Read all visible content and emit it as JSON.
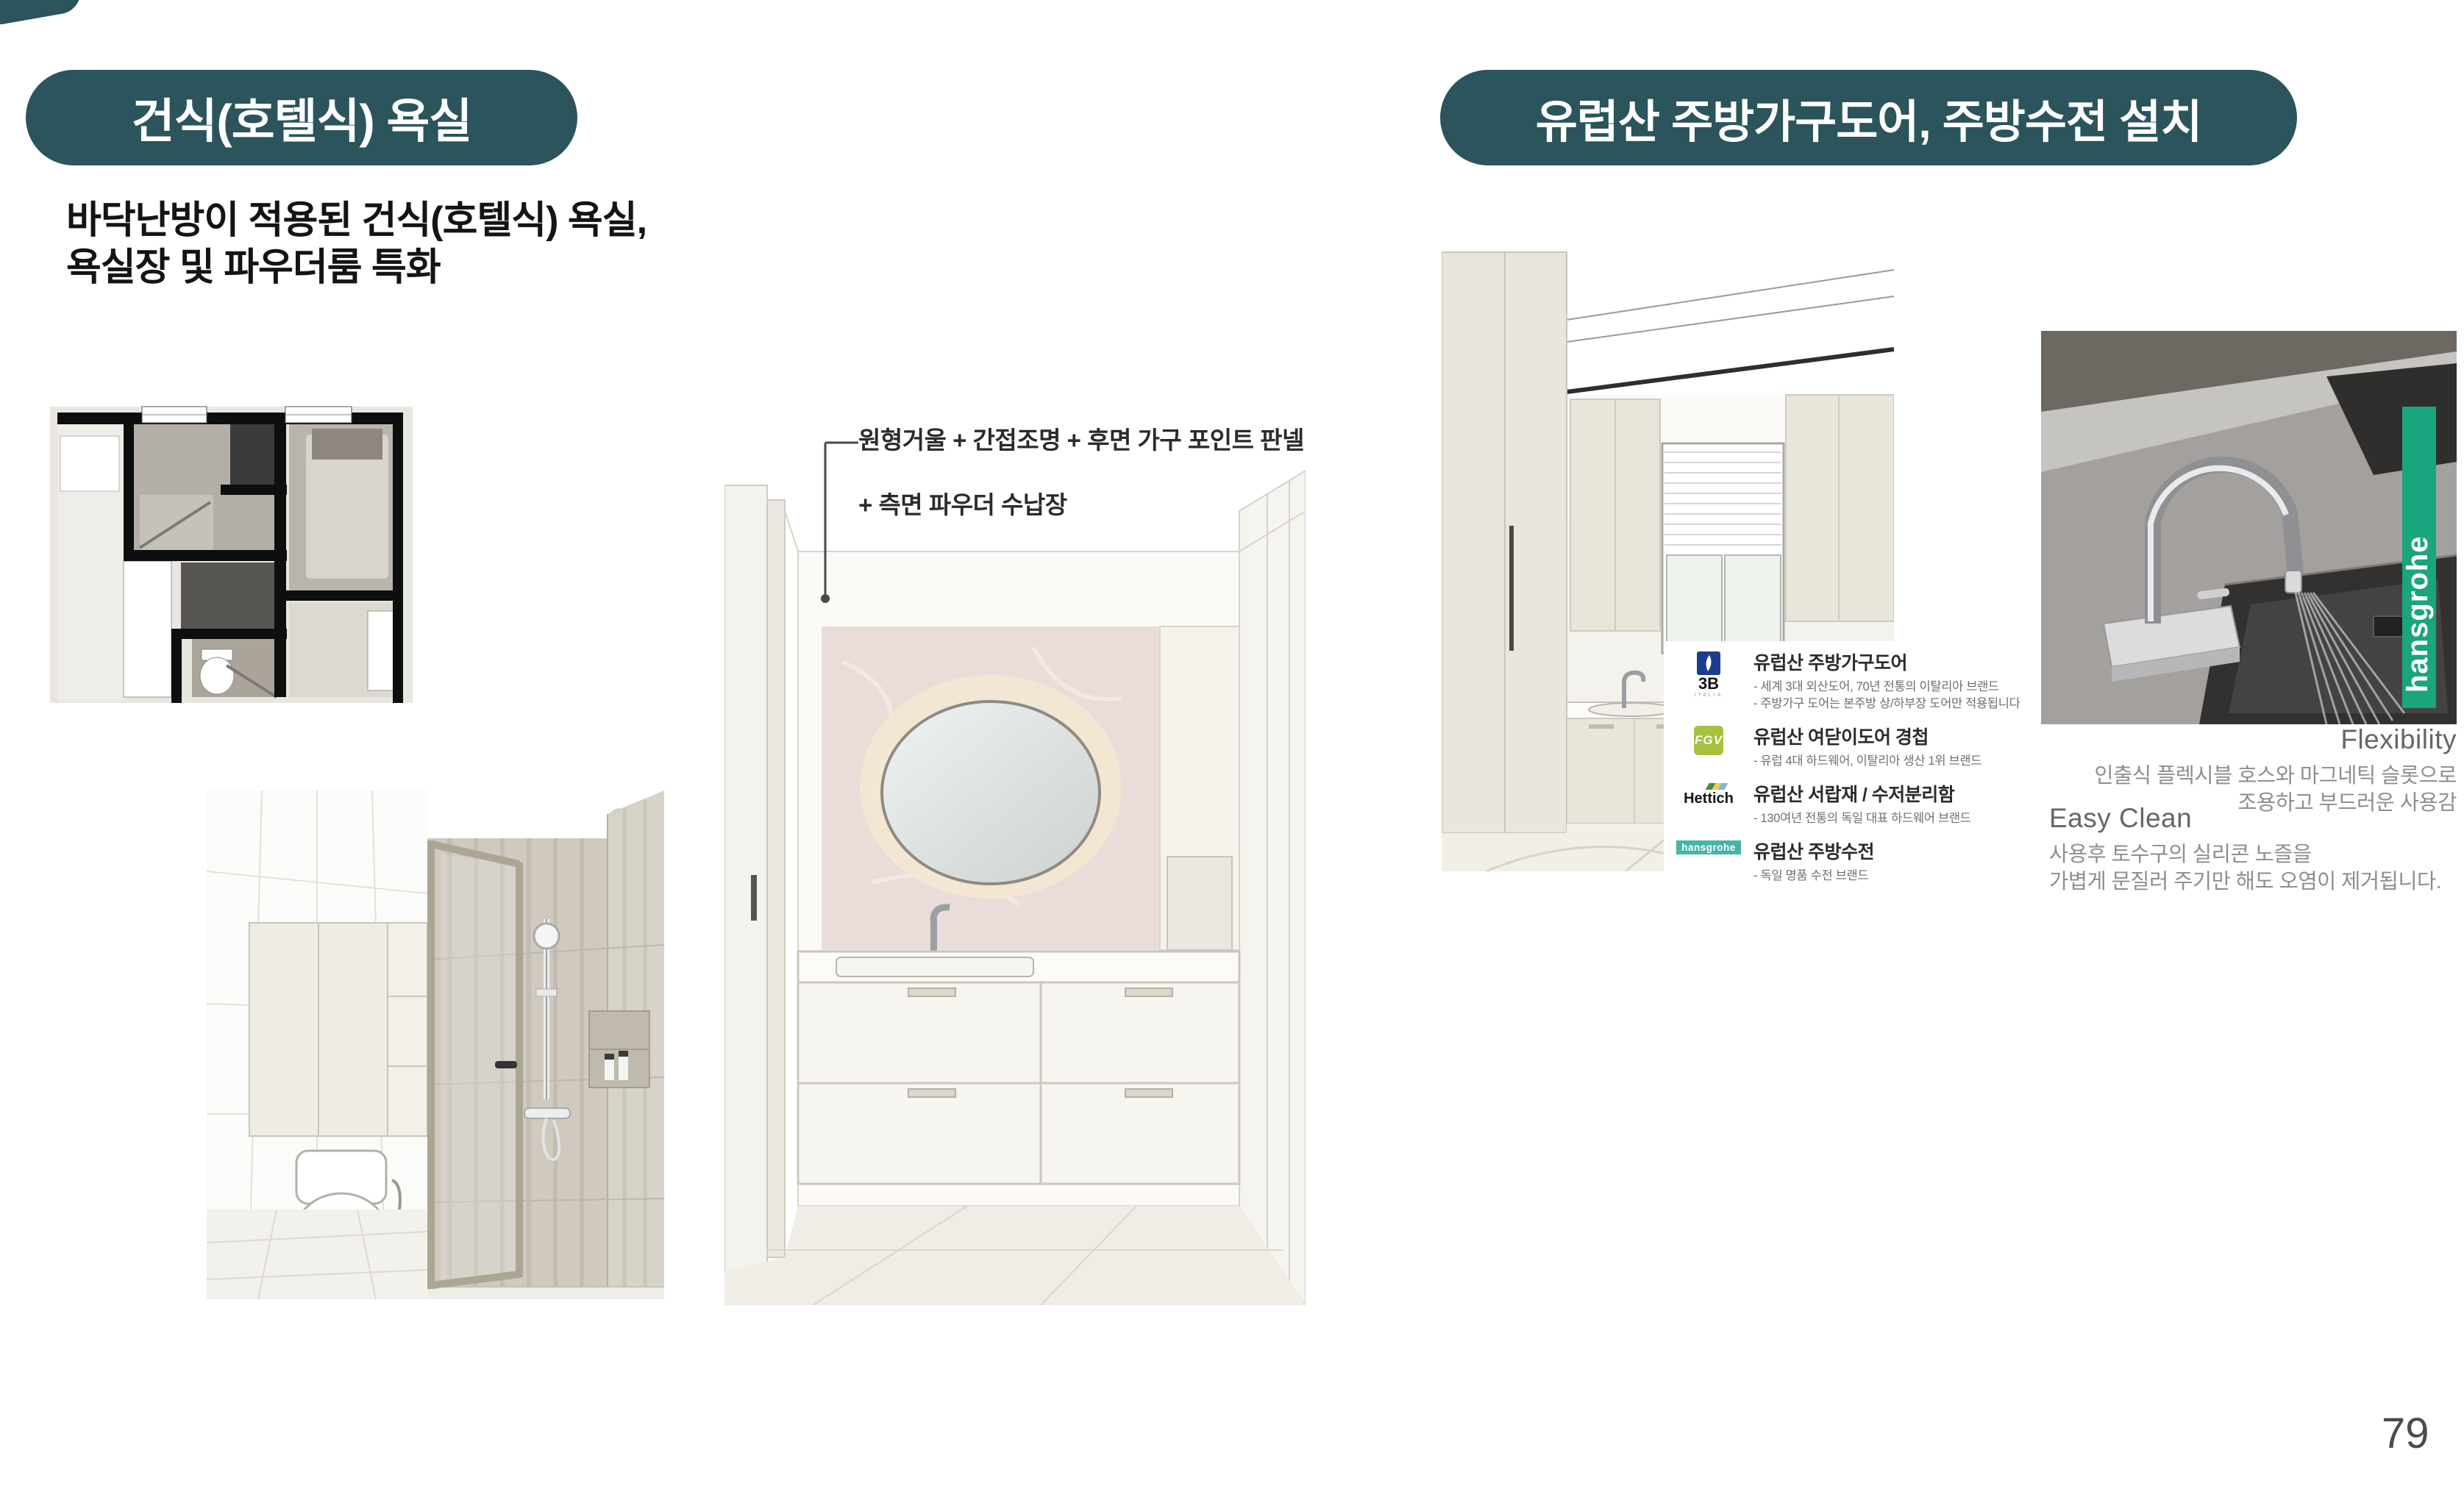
{
  "page": {
    "number": "79"
  },
  "colors": {
    "accent_teal": "#2b545c",
    "hansgrohe_green": "#19a57e",
    "hansgrohe_logo_teal": "#44b5a6",
    "b3_blue": "#1c3d8e",
    "fgv_green": "#a6c23e"
  },
  "left_section": {
    "badge_label": "건식(호텔식) 욕실",
    "description": {
      "line1": "바닥난방이 적용된 건식(호텔식) 욕실,",
      "line2": "욕실장 및 파우더룸 특화"
    },
    "powder_annotation": {
      "line1": "원형거울 + 간접조명 + 후면 가구 포인트 판넬",
      "line2": "+ 측면 파우더 수납장"
    }
  },
  "right_section": {
    "badge_label": "유럽산 주방가구도어, 주방수전 설치",
    "brands": [
      {
        "logo_text": "3B",
        "logo_sub": "ITALIA",
        "title": "유럽산 주방가구도어",
        "desc1": "- 세계 3대 외산도어, 70년 전통의 이탈리아 브랜드",
        "desc2": "- 주방가구 도어는 본주방 상/하부장 도어만 적용됩니다"
      },
      {
        "logo_text": "FGV",
        "title": "유럽산 여닫이도어 경첩",
        "desc1": "- 유럽 4대 하드웨어, 이탈리아 생산 1위 브랜드"
      },
      {
        "logo_text": "Hettich",
        "title": "유럽산 서랍재 / 수저분리함",
        "desc1": "- 130여년 전통의 독일 대표 하드웨어 브랜드"
      },
      {
        "logo_text": "hansgrohe",
        "title": "유럽산 주방수전",
        "desc1": "- 독일 명품 수전 브랜드"
      }
    ],
    "faucet_brand_tab": "hansgrohe",
    "features": [
      {
        "title": "Flexibility",
        "line1": "인출식 플렉시블 호스와 마그네틱 슬롯으로",
        "line2": "조용하고 부드러운 사용감"
      },
      {
        "title": "Easy Clean",
        "line1": "사용후 토수구의 실리콘 노즐을",
        "line2": "가볍게 문질러 주기만 해도 오염이 제거됩니다."
      }
    ]
  }
}
